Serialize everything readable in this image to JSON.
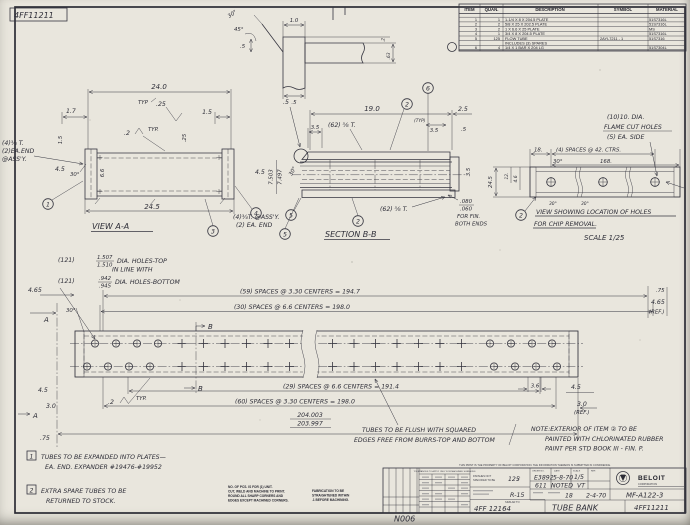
{
  "sheet": {
    "paper": "#e9e6dd",
    "ink": "#35353f",
    "corner_drawing_no": "4FF11211"
  },
  "parts_table": {
    "headers": {
      "item": "ITEM",
      "quan": "QUAN.",
      "desc": "DESCRIPTION",
      "symbol": "SYMBOL",
      "material": "MATERIAL"
    },
    "rows": [
      {
        "item": "1",
        "quan": "1",
        "desc": "1-1/4 X 8 X 204.5 PLATE",
        "symbol": "",
        "material": "51S7316L"
      },
      {
        "item": "2",
        "quan": "2",
        "desc": "5/8 X 25 X 202.5 PLATE",
        "symbol": "",
        "material": "51S7316L"
      },
      {
        "item": "3",
        "quan": "2",
        "desc": "1 X 6.6 X 25 PLATE",
        "symbol": "",
        "material": "MS"
      },
      {
        "item": "4",
        "quan": "1",
        "desc": "3/4 X 8 X 204.5 PLATE",
        "symbol": "",
        "material": "51S7316L"
      },
      {
        "item": "5",
        "quan": "125",
        "desc": "FLOW TUBE",
        "symbol": "2AYL7211  -  1",
        "material": "51S7316"
      },
      {
        "item": "",
        "quan": "",
        "desc": "INCLUDES (3) SPARES",
        "symbol": "",
        "material": ""
      },
      {
        "item": "6",
        "quan": "4",
        "desc": "1/4 X 1 BAR X 204 LG",
        "symbol": "",
        "material": "51S7304L"
      }
    ]
  },
  "weld_detail": {
    "angle_top": "30°",
    "angle_45": "45°",
    "dim_half_left": ".5",
    "dim_width": "1.0",
    "dim_point2": ".2",
    "dim_63": ".63",
    "dim_half_bottom": ".5"
  },
  "view_aa": {
    "dim_24_0": "24.0",
    "dim_1_7": "1.7",
    "typ_flag": "TYP",
    "dim_25": ".25",
    "dim_1_5_right": "1.5",
    "weld_size": ".2",
    "weld_typ": "TYP.",
    "dim_1_5_left": "1.5",
    "dim_25_inner": ".25",
    "end_note_1": "(4)¾ T.",
    "end_note_2": "(2)EA.END",
    "end_note_3": "@ASS'Y.",
    "dim_4_5": "4.5",
    "angle_30": "30°",
    "dim_6_6": "6.6",
    "dim_24_5": "24.5",
    "title": "VIEW A-A",
    "balloon_1": "1",
    "balloon_3": "3",
    "balloon_4": "4",
    "balloon_5": "5",
    "assy_note_1": "(4)¾T. @ASS'Y.",
    "assy_note_2": "(2) EA. END",
    "dim_4_5_right": "4.5",
    "dim_7503": "7.503",
    "dim_7497": "7.497"
  },
  "section_bb": {
    "dim_19_0": "19.0",
    "dim_2_5": "2.5",
    "dim_half": ".5",
    "dim_3_5_left": "3.5",
    "tubes_note_top": "(62) ⅝ T.",
    "typ_small": "(TYP)",
    "dim_3_5_right": "3.5",
    "dim_half_right": ".5",
    "angle_30": "30°",
    "balloon_2_top": "2",
    "balloon_6": "6",
    "balloon_5": "5",
    "balloon_2_bottom": "2",
    "tubes_note_bottom": "(62) ⅝ T.",
    "fin_num": ".080",
    "fin_den": ".060",
    "fin_line1": "FOR FIN.",
    "fin_line2": "BOTH ENDS",
    "title": "SECTION B-B",
    "dim_3_5_rot": "3.5"
  },
  "holes_view": {
    "note_1": "(10)10. DIA.",
    "note_2": "FLAME CUT HOLES",
    "note_3": "(5) EA. SIDE",
    "dim_18": "18.",
    "dim_spaces": "(4) SPACES @ 42. CTRS.",
    "angle_30": "30°",
    "dim_168": "168.",
    "dim_24_5": "24.5",
    "dim_12": "12.",
    "dim_4_6": "4.6",
    "balloon_2": "2",
    "brk_30_a": "30°",
    "brk_30_b": "30°",
    "title_1": "VIEW SHOWING LOCATION OF HOLES",
    "title_2": "FOR CHIP REMOVAL.",
    "scale": "SCALE 1/25"
  },
  "bank": {
    "holes_top_qty": "(121)",
    "holes_top_num": "1.507",
    "holes_top_den": "1.510",
    "holes_top_label": "DIA. HOLES-TOP",
    "holes_mid_label": "IN LINE WITH",
    "holes_bot_qty": "(121)",
    "holes_bot_num": ".942",
    "holes_bot_den": ".945",
    "holes_bot_label": "DIA. HOLES-BOTTOM",
    "dim_4_65_left": "4.65",
    "angle_30_left": "30°",
    "section_a_top": "A",
    "section_b_top": "B",
    "spaces_59": "(59) SPACES @ 3.30 CENTERS = 194.7",
    "spaces_30": "(30) SPACES @ 6.6 CENTERS = 198.0",
    "dim_75_right": ".75",
    "dim_4_65_right": "4.65",
    "ref_right": "(REF.)",
    "weld_size": ".2",
    "weld_typ": "TYP.",
    "dim_4_5_left": "4.5",
    "dim_3_0_left": "3.0",
    "section_a_bottom": "A",
    "dim_75_bottom": ".75",
    "section_b_bottom": "B",
    "spaces_29": "(29) SPACES @ 6.6 CENTERS = 191.4",
    "spaces_60": "(60) SPACES @ 3.30 CENTERS = 198.0",
    "dim_204_num": "204.003",
    "dim_204_den": "203.997",
    "dim_3_6": "3.6",
    "dim_4_5_right": "4.5",
    "dim_3_0_right": "3.0",
    "ref_bottom": "(REF.)",
    "flush_note_1": "TUBES TO BE FLUSH WITH SQUARED",
    "flush_note_2": "EDGES FREE FROM BURRS-TOP AND BOTTOM",
    "paint_note_1": "NOTE:EXTERIOR OF ITEM ② TO BE",
    "paint_note_2": "PAINTED WITH CHLORINATED RUBBER",
    "paint_note_3": "PAINT PER STD BOOK III - FIN. P."
  },
  "notes": {
    "n1_no": "1",
    "n1_line1": "TUBES TO BE EXPANDED INTO PLATES—",
    "n1_line2": "EA. END. EXPANDER #19476-#19952",
    "n2_no": "2",
    "n2_line1": "EXTRA SPARE TUBES TO BE",
    "n2_line2": "RETURNED TO STOCK."
  },
  "small_print": {
    "b1_l1": "NO. OF PCS. IS FOR (1) UNIT.",
    "b1_l2": "CUT, WELD AND MACHINE TO PRINT.",
    "b1_l3": "ROUND ALL SHARP CORNERS AND",
    "b1_l4": "EDGES EXCEPT MACHINED CORNERS.",
    "b2_l1": "FABRICATION TO BE",
    "b2_l2": "STRAIGHTENED WITHIN",
    "b2_l3": ".1  BEFORE MACHINING."
  },
  "title_block": {
    "confidence": "THIS PRINT IS THE PROPERTY OF BELOIT CORPORATION. THE INFORMATION THEREON IS SUBMITTED IN CONFIDENCE.",
    "tol_header": "TOLERANCES TO APPLY ONLY FOR MACHINED SURFACES",
    "finish_label_1": "FINISHES NOT",
    "finish_label_2": "SPECIFIED TO BE",
    "finish_value": "125",
    "order_label": "ORDER NO.",
    "date_label": "DATE",
    "scale_label": "SCALE",
    "ref_label": "REF.",
    "order_no": "E3892",
    "date": "5-8-70",
    "scale": "1/5",
    "row2_a": "611",
    "row2_b": "NOTED",
    "row2_c": "VT",
    "row3_a": "R-15",
    "row3_b": "18",
    "row3_c": "2-4-70",
    "similar_label": "SIMILAR TO",
    "pattern_no": "4FF 12164",
    "title": "TUBE BANK",
    "drawing_no": "4FF11211",
    "ref_drawing": "MF-A122-3",
    "brand": "BELOIT",
    "brand_sub": "CORPORATION",
    "sheet_code": "N006"
  }
}
